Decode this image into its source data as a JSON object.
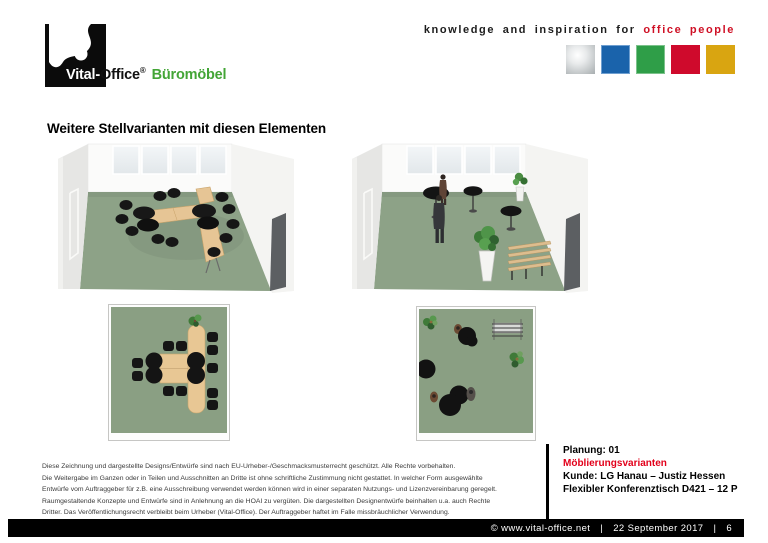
{
  "header": {
    "logo": {
      "part1": "Vital-",
      "part2": "Office",
      "reg": "®",
      "suffix": "Büromöbel",
      "suffix_color": "#43a536"
    },
    "tagline": {
      "text_black": "knowledge and inspiration for",
      "text_red": "office people",
      "red_color": "#cf1025"
    },
    "brand_squares": [
      {
        "name": "silver",
        "color": "#b0b5b7"
      },
      {
        "name": "blue",
        "color": "#1a63ab"
      },
      {
        "name": "green",
        "color": "#2f9e48"
      },
      {
        "name": "red",
        "color": "#cf0a2c"
      },
      {
        "name": "gold",
        "color": "#d9a511"
      }
    ]
  },
  "page_title": "Weitere Stellvarianten mit diesen Elementen",
  "figure_colors": {
    "floor_green": "#8da287",
    "plan_green": "#8a9f83",
    "beech_wood": "#e6c595",
    "chair_black": "#161616",
    "wall_gray": "#e6e6e4",
    "column_dark": "#5c5f62"
  },
  "disclaimer": {
    "lines": [
      "Diese Zeichnung und dargestellte Designs/Entwürfe sind nach EU-Urheber-/Geschmacksmusterrecht geschützt. Alle Rechte vorbehalten.",
      "Die Weitergabe im Ganzen oder in Teilen und Ausschnitten an Dritte ist ohne schriftliche Zustimmung nicht gestattet. In welcher Form ausgewählte",
      "Entwürfe vom Auftraggeber für z.B. eine Ausschreibung verwendet werden können wird in einer separaten Nutzungs- und Lizenzvereinbarung geregelt.",
      "Raumgestaltende Konzepte und Entwürfe sind in Anlehnung an die HOAI zu vergüten. Die dargestellten Designentwürfe beinhalten u.a. auch Rechte",
      "Dritter. Das Veröffentlichungsrecht verbleibt beim Urheber (Vital-Office). Der Auftraggeber haftet im Falle missbräuchlicher Verwendung."
    ]
  },
  "project_info": {
    "line1": "Planung: 01",
    "line2": "Möblierungsvarianten",
    "line2_color": "#e2001a",
    "line3": "Kunde: LG Hanau – Justiz Hessen",
    "line4": "Flexibler Konferenztisch D421 – 12 P"
  },
  "footer": {
    "copyright": "© www.vital-office.net",
    "separator": "|",
    "date": "22 September 2017",
    "page": "6"
  }
}
